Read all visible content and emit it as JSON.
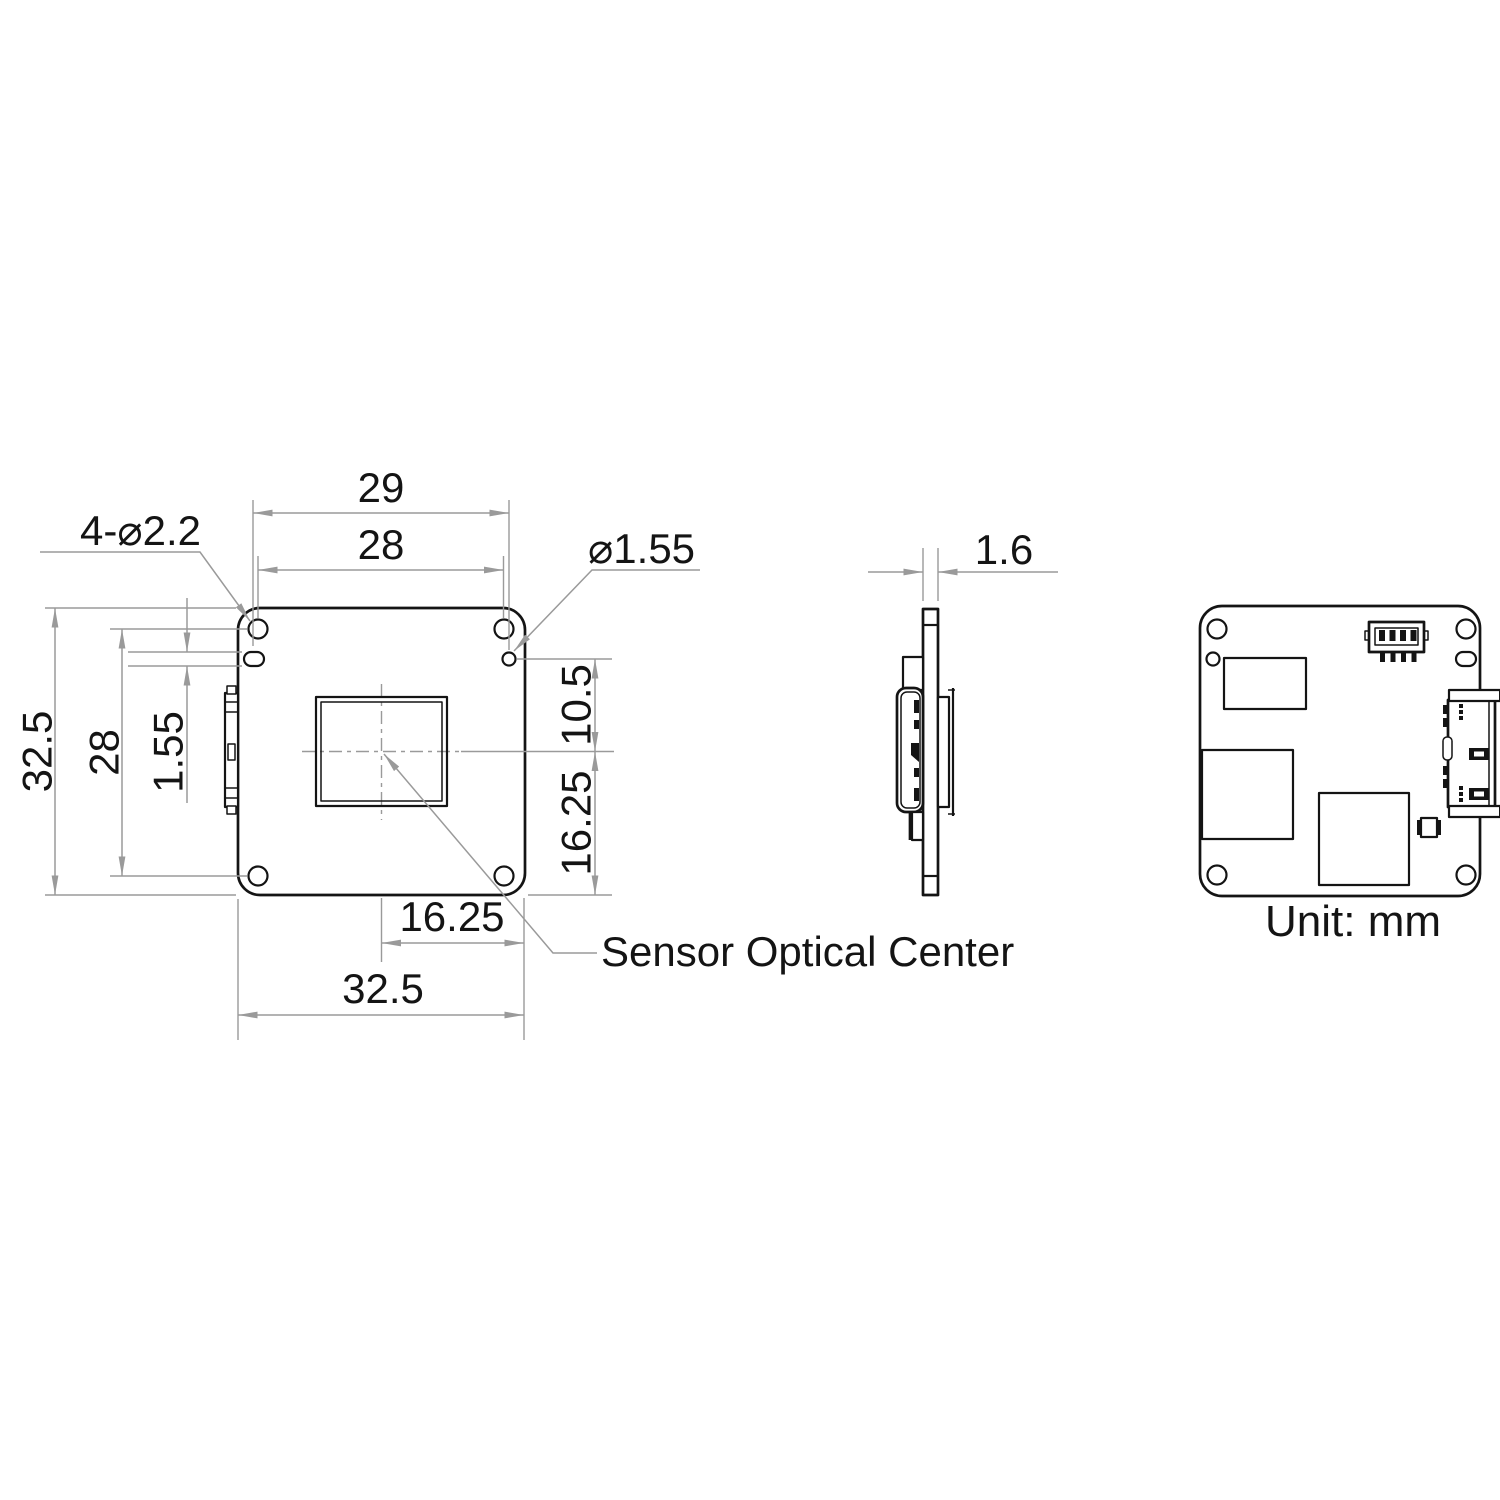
{
  "drawing": {
    "unit_note": "Unit: mm",
    "colors": {
      "part_line": "#141414",
      "dimension_line": "#9a9a9a",
      "background": "#ffffff"
    },
    "front": {
      "dim29": "29",
      "dim28_top": "28",
      "dim32_5_left": "32.5",
      "dim28_left": "28",
      "dim1_55_left": "1.55",
      "dim10_5_right": "10.5",
      "dim16_25_right": "16.25",
      "dim16_25_bottom": "16.25",
      "dim32_5_bottom": "32.5",
      "callout_mounting_holes": "4-⌀2.2",
      "callout_locating_hole": "⌀1.55",
      "callout_sensor_center": "Sensor Optical Center"
    },
    "side": {
      "dim_thickness": "1.6"
    }
  }
}
